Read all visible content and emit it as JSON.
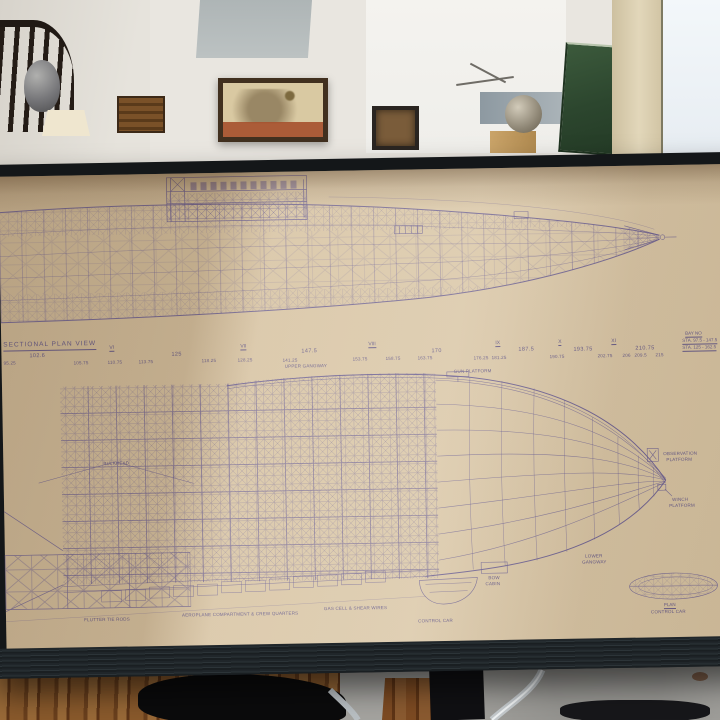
{
  "scene_description": "Photograph of a framed antique airship (dirigible) blueprint leaning against a gallery wall, with gallery interior above and wood/concrete floor below",
  "colors": {
    "paper": "#d6c2a2",
    "ink": "#564c86",
    "frame": "#141719",
    "wall": "#e9e6e0",
    "wood_floor": "#8a5a2c",
    "relief_green": "#2c462e"
  },
  "blueprint": {
    "view_title": "SECTIONAL PLAN VIEW",
    "bay_box": {
      "title": "BAY NO",
      "row1": "STA. 97.5 - 147.5",
      "row2": "STA. 125 - 162.5"
    },
    "roman_numerals": [
      "VI",
      "VII",
      "VIII",
      "IX",
      "X",
      "XI"
    ],
    "stations_major": [
      "102.6",
      "125",
      "147.5",
      "170",
      "187.5",
      "193.75",
      "210.75"
    ],
    "stations_minor": [
      "95.25",
      "105.75",
      "110.75",
      "113.75",
      "118.25",
      "128.25",
      "141.25",
      "153.75",
      "158.75",
      "163.75",
      "176.25",
      "181.25",
      "190.75",
      "202.75",
      "206",
      "209.5",
      "215"
    ],
    "labels": {
      "upper_gangway": "UPPER GANGWAY",
      "gun_platform": "GUN PLATFORM",
      "bulkhead": "BULKHEAD",
      "observation_platform_1": "OBSERVATION",
      "observation_platform_2": "PLATFORM",
      "winch_platform_1": "WINCH",
      "winch_platform_2": "PLATFORM",
      "lower_gangway_1": "LOWER",
      "lower_gangway_2": "GANGWAY",
      "bow_cabin_1": "BOW",
      "bow_cabin_2": "CABIN",
      "flutter_tie_rods": "FLUTTER TIE RODS",
      "aeroplane_compartment": "AEROPLANE COMPARTMENT & CREW QUARTERS",
      "gas_cell_wires": "GAS CELL & SHEAR WIRES",
      "control_car": "CONTROL CAR",
      "plan_label_1": "PLAN",
      "plan_label_2": "CONTROL CAR"
    }
  }
}
